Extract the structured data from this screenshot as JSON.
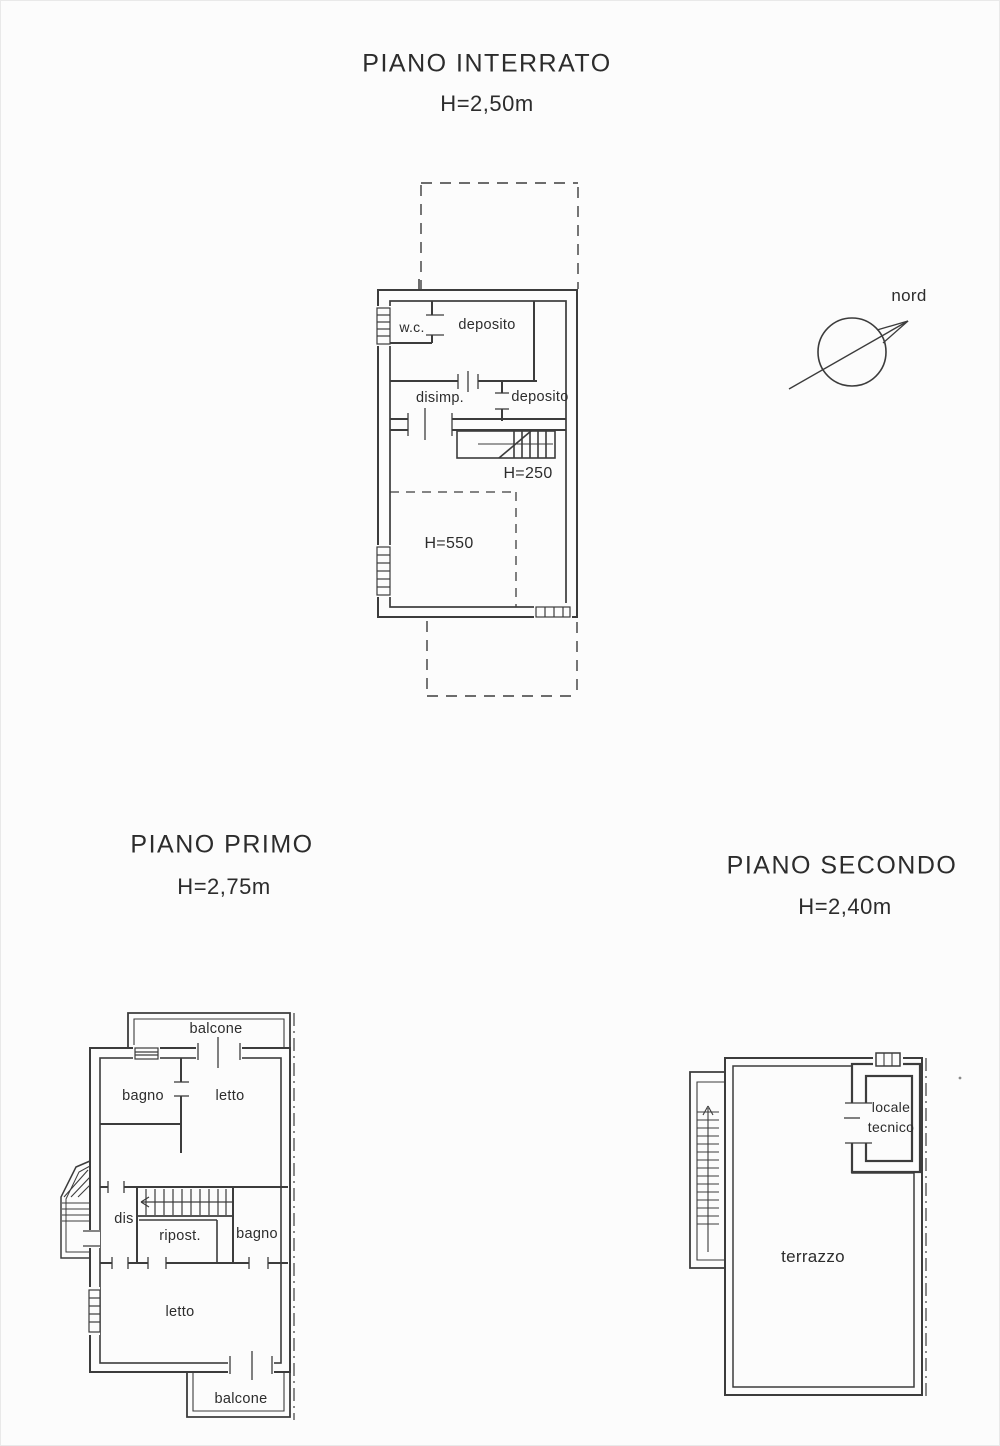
{
  "colors": {
    "ink": "#3c3c3c",
    "paper": "#fcfcfc"
  },
  "compass": {
    "label": "nord"
  },
  "interrato": {
    "title": "PIANO INTERRATO",
    "height_label": "H=2,50m",
    "rooms": {
      "wc": "w.c.",
      "deposito_top": "deposito",
      "disimp": "disimp.",
      "deposito_right": "deposito"
    },
    "annotations": {
      "h_stairs": "H=250",
      "h_room": "H=550"
    }
  },
  "primo": {
    "title": "PIANO PRIMO",
    "height_label": "H=2,75m",
    "rooms": {
      "balcone_top": "balcone",
      "bagno_top": "bagno",
      "letto_top": "letto",
      "dis": "dis",
      "ripost": "ripost.",
      "bagno_bottom": "bagno",
      "letto_bottom": "letto",
      "balcone_bottom": "balcone"
    }
  },
  "secondo": {
    "title": "PIANO SECONDO",
    "height_label": "H=2,40m",
    "rooms": {
      "locale_tecnico_line1": "locale",
      "locale_tecnico_line2": "tecnico",
      "terrazzo": "terrazzo"
    }
  }
}
